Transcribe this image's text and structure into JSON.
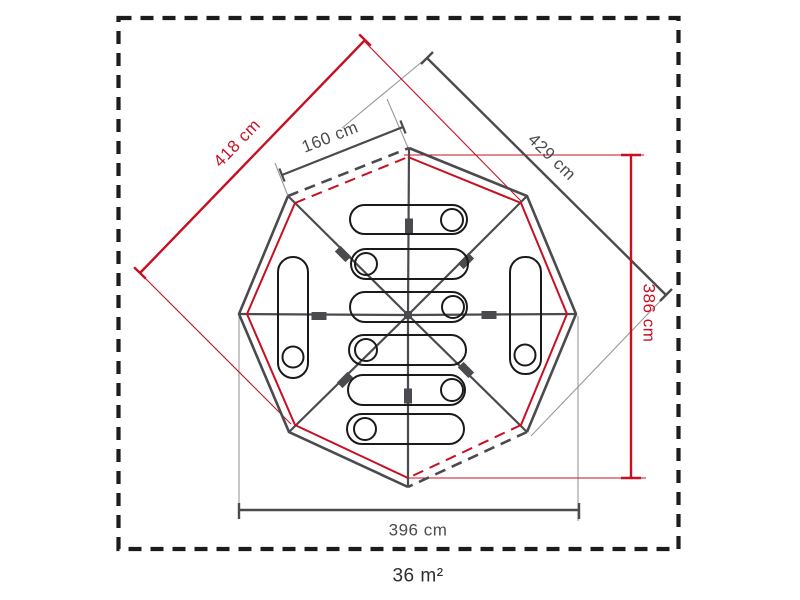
{
  "diagram": {
    "type": "tent-floorplan-top-view",
    "shape": "octagon",
    "area_label": "36 m²",
    "sleeping_bag_count": 8,
    "door_count": 2,
    "dimensions": [
      {
        "id": "diagonal-upper-left",
        "label": "418 cm",
        "color": "#c81023",
        "orientation": "diagonal-45-up"
      },
      {
        "id": "panel-width-top",
        "label": "160 cm",
        "color": "#4b4b4f",
        "orientation": "diagonal-22-up"
      },
      {
        "id": "diagonal-upper-right",
        "label": "429 cm",
        "color": "#4b4b4f",
        "orientation": "diagonal-45-down"
      },
      {
        "id": "height-right",
        "label": "386 cm",
        "color": "#c81023",
        "orientation": "vertical"
      },
      {
        "id": "width-bottom",
        "label": "396 cm",
        "color": "#4b4b4f",
        "orientation": "horizontal"
      }
    ],
    "colors": {
      "accent_red": "#c81023",
      "line_gray": "#4b4b4f",
      "thin_gray": "#999999",
      "border_black": "#1c1c1c",
      "bag_outline": "#1a1a1a",
      "text_dark": "#2e2e2e"
    }
  }
}
